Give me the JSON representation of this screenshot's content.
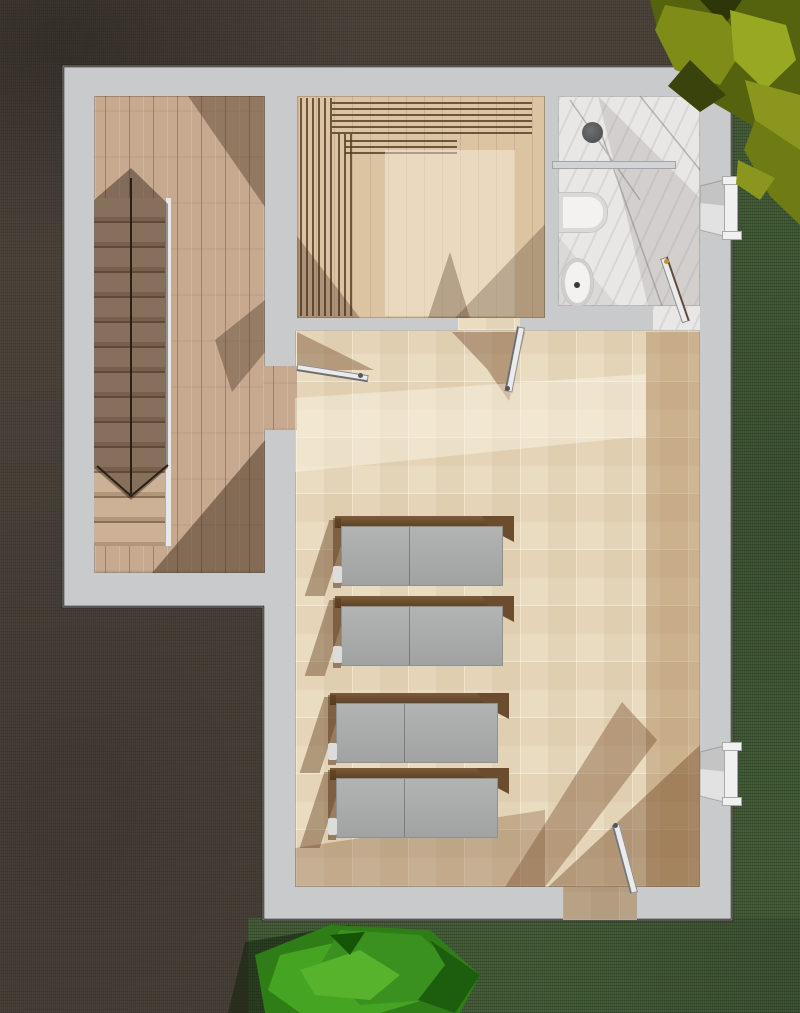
{
  "scene": {
    "kind": "architectural-floor-plan-3d-render",
    "view": "top-down",
    "description": "Top-down 3D render of a single-storey spa/sauna floor plan on dark ground with lawn",
    "rooms": [
      "stair-hall",
      "sauna",
      "bathroom",
      "relaxation-room"
    ],
    "fixture_counts": {
      "loungers": 4,
      "windows": 2,
      "interior_doors": 3,
      "exterior_doors": 1,
      "toilets": 1,
      "bathtubs": 1,
      "showers": 1,
      "staircases": 1,
      "bushes": 2
    }
  },
  "colors": {
    "ground": "#473f36",
    "grass": "#465f3a",
    "wall": "#c9cacc",
    "outline": "#1f1c17",
    "wood-floor": "#c6a98f",
    "sauna-floor": "#dcc3a2",
    "tile-floor": "#eadcc0",
    "marble": "#e9e7e5",
    "shadow-brown": "#6e4522",
    "lounger-cushion": "#a9aba9",
    "lounger-wood": "#64472b",
    "fixture-white": "#f3f2f1",
    "door-leaf": "#ebebec",
    "bush-yellow": "#8a961e",
    "bush-yellow-dark": "#4a560e",
    "bush-green": "#3c9021",
    "bush-green-dark": "#1c5e0d",
    "metal": "#5a5c5e",
    "brass": "#b9962f"
  }
}
